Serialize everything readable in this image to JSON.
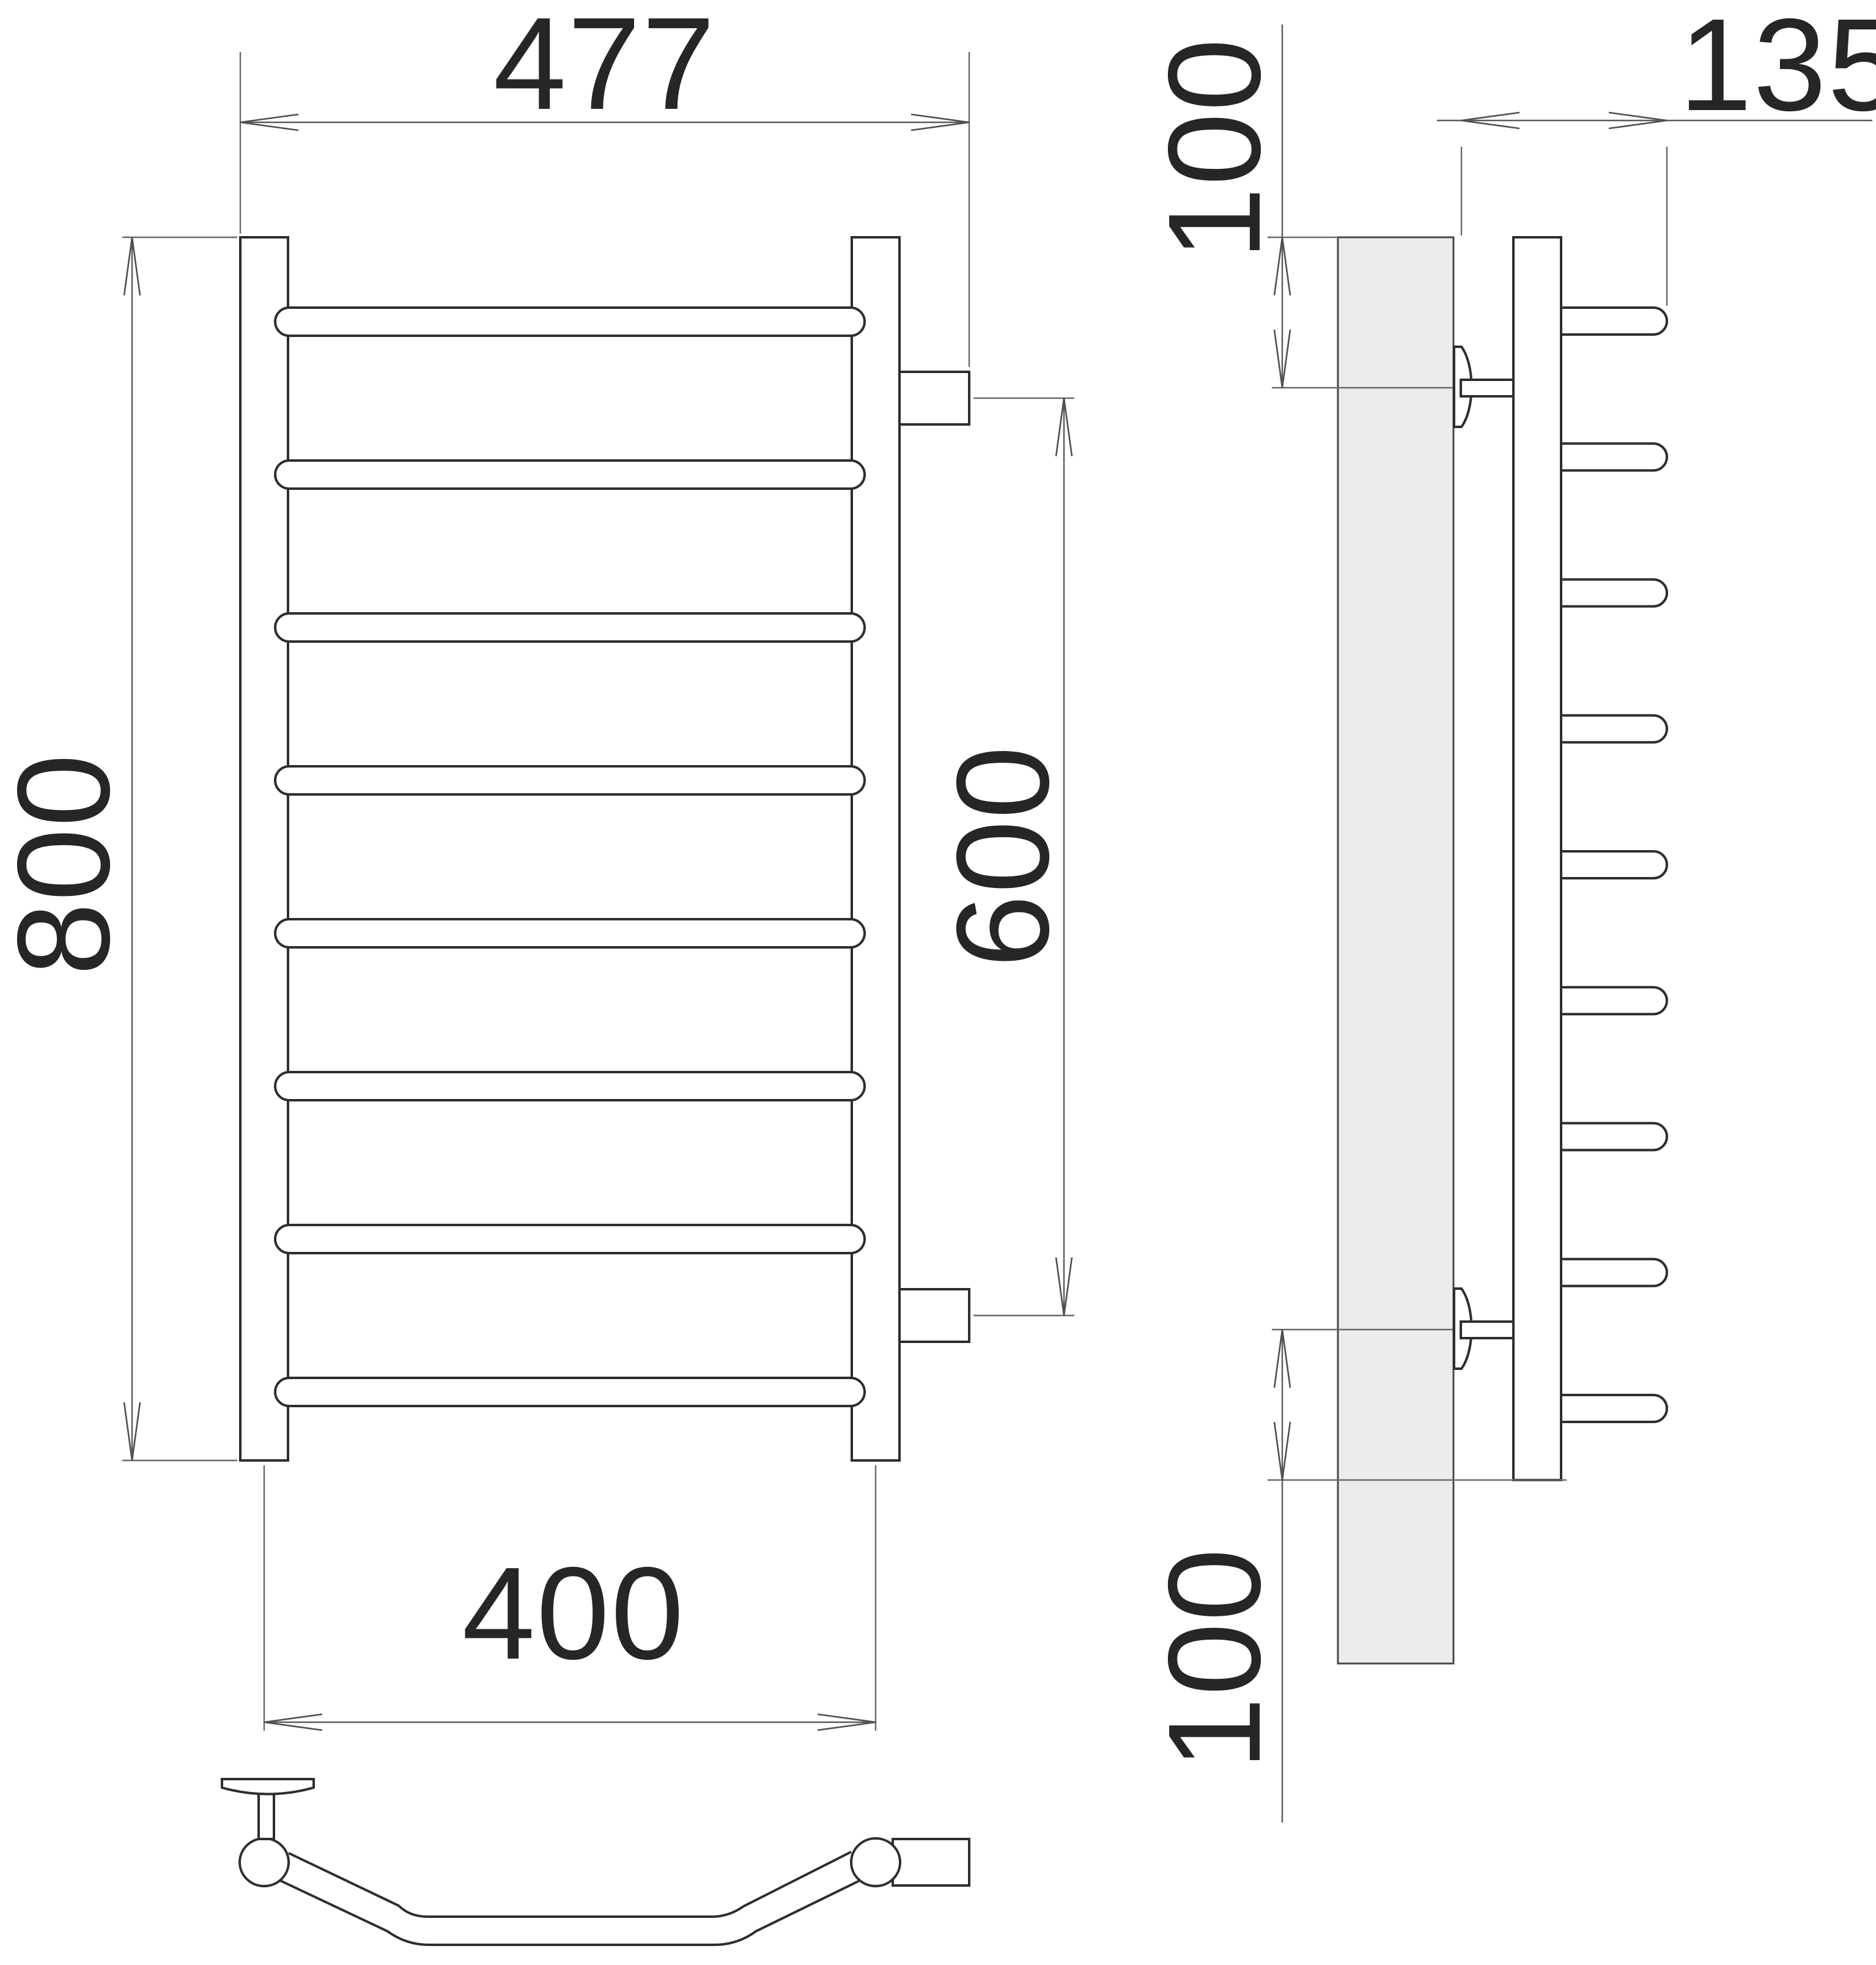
{
  "title": "towel-rail-technical-drawing",
  "dims": {
    "overall_width": "477",
    "overall_height": "800",
    "rail_axis_width": "400",
    "connection_spacing": "600",
    "depth_from_wall": "135",
    "top_bracket_offset": "100",
    "bottom_bracket_offset": "100"
  },
  "front_view": {
    "rung_count": 8,
    "stub_count": 2
  },
  "side_view": {
    "peg_count": 9,
    "bracket_count": 2
  },
  "plan_view": {
    "rung_count": 1,
    "bracket_count": 1
  },
  "colors": {
    "line": "#2e2e2e",
    "dim_line": "#5a5a5a",
    "wall_plate_fill": "#ebecec",
    "background": "#ffffff"
  }
}
